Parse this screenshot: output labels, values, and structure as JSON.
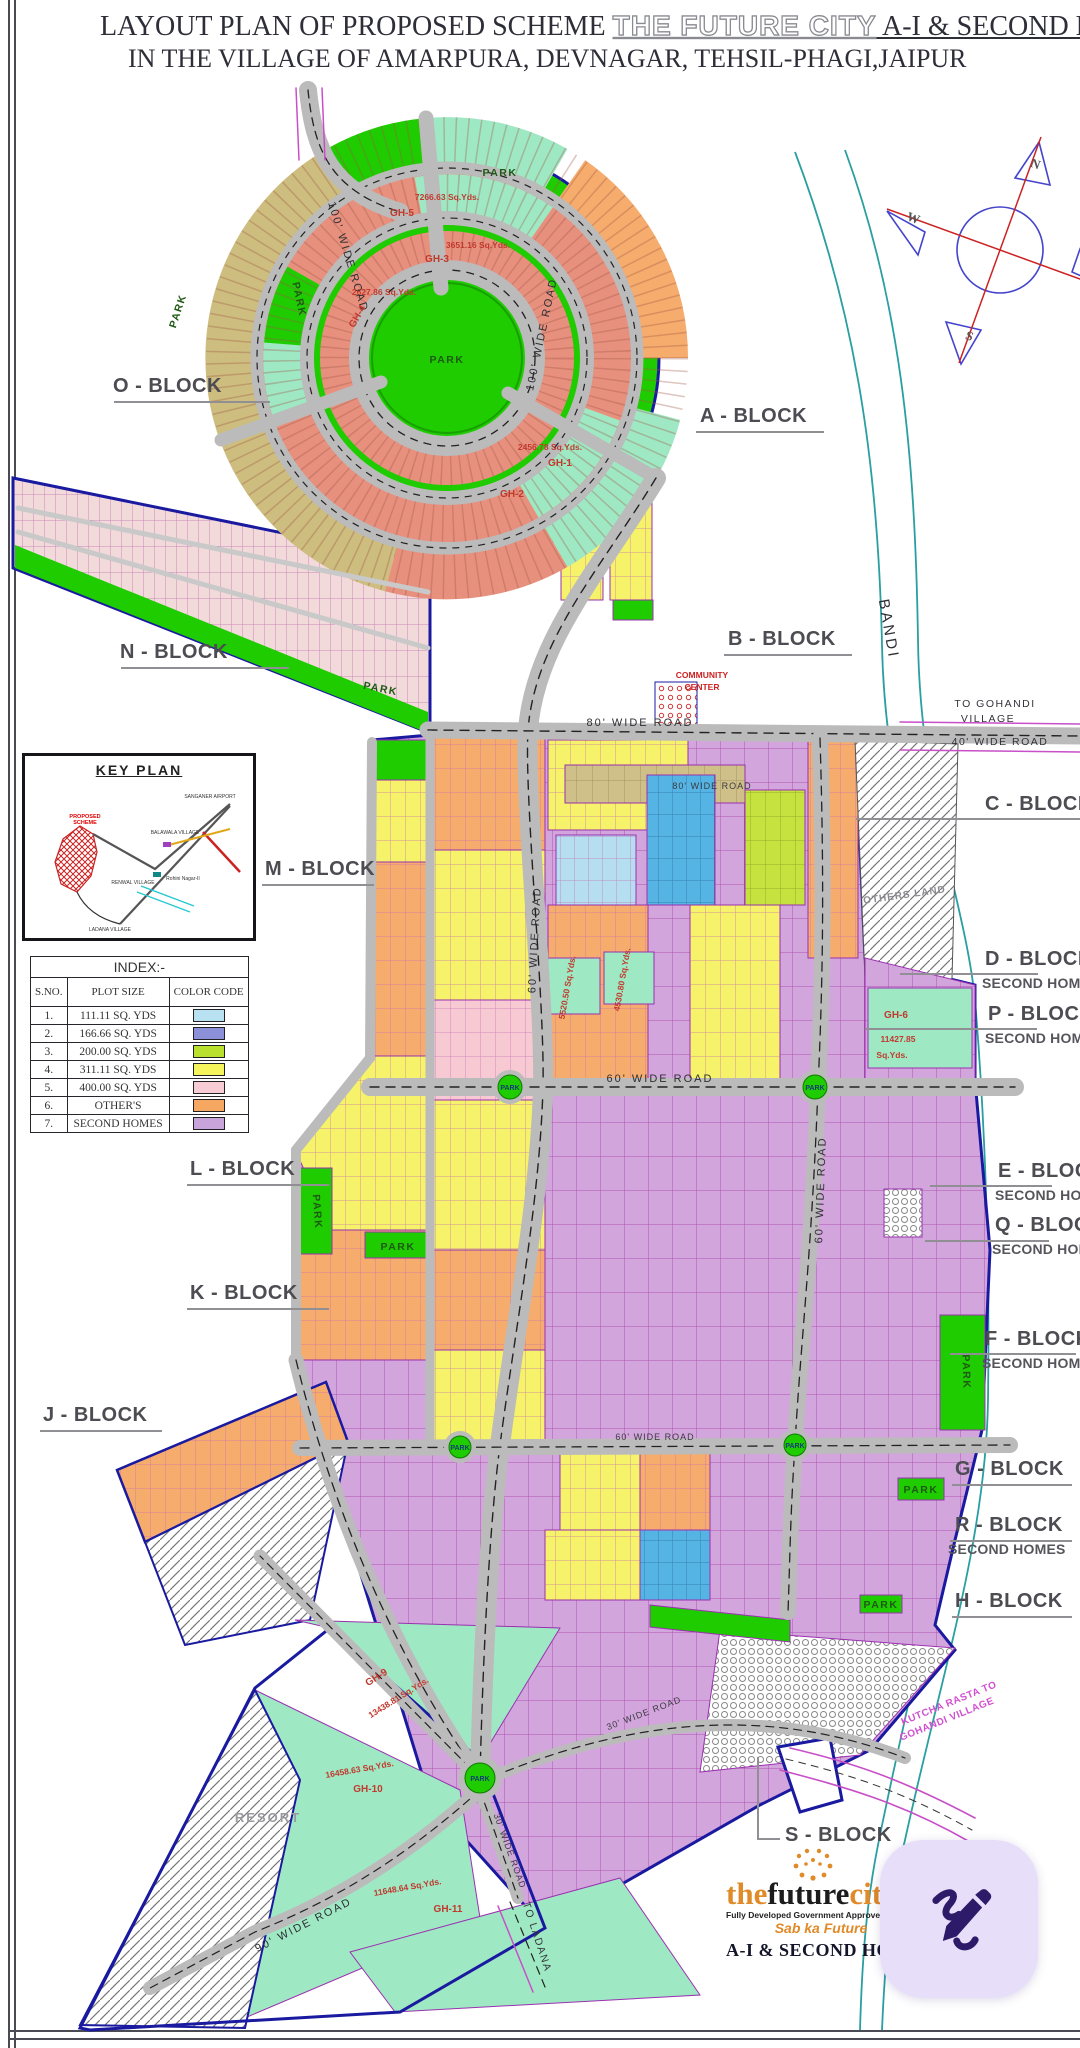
{
  "title": {
    "line1_prefix": "LAYOUT PLAN OF PROPOSED SCHEME ",
    "line1_brand": "THE FUTURE CITY",
    "line1_suffix": " A-I  & SECOND HOMES",
    "line2": "IN THE VILLAGE OF  AMARPURA, DEVNAGAR, TEHSIL-PHAGI,JAIPUR"
  },
  "blocks": {
    "o": "O - BLOCK",
    "a": "A - BLOCK",
    "n": "N - BLOCK",
    "b": "B - BLOCK",
    "c": "C - BLOCK",
    "m": "M - BLOCK",
    "d": "D - BLOCK",
    "p": "P - BLOCK",
    "l": "L - BLOCK",
    "e": "E - BLOCK",
    "q": "Q - BLOCK",
    "k": "K - BLOCK",
    "f": "F - BLOCK",
    "j": "J - BLOCK",
    "g": "G - BLOCK",
    "r": "R - BLOCK",
    "h": "H - BLOCK",
    "s": "S - BLOCK",
    "second_homes": "SECOND HOMES",
    "second_home": "SECOND HOME"
  },
  "index": {
    "title": "INDEX:-",
    "headers": [
      "S.NO.",
      "PLOT SIZE",
      "COLOR CODE"
    ],
    "rows": [
      {
        "sno": "1.",
        "size": "111.11 SQ. YDS",
        "color": "#b8e2f2"
      },
      {
        "sno": "2.",
        "size": "166.66 SQ. YDS",
        "color": "#8b90d8"
      },
      {
        "sno": "3.",
        "size": "200.00 SQ. YDS",
        "color": "#b8e02c"
      },
      {
        "sno": "4.",
        "size": "311.11 SQ. YDS",
        "color": "#f6f45c"
      },
      {
        "sno": "5.",
        "size": "400.00 SQ. YDS",
        "color": "#f8ccd4"
      },
      {
        "sno": "6.",
        "size": "OTHER'S",
        "color": "#f6a862"
      },
      {
        "sno": "7.",
        "size": "SECOND HOMES",
        "color": "#c9a4da"
      }
    ]
  },
  "key_plan": {
    "title": "KEY PLAN",
    "proposed_1": "PROPOSED",
    "proposed_2": "SCHEME",
    "airport": "SANGANER AIRPORT",
    "balawala": "BALAWALA VILLAGE",
    "renwal": "RENWAL VILLAGE",
    "rohini": "Rohini Nagar-II",
    "ladana": "LADANA VILLAGE"
  },
  "roads": {
    "r100": "100' WIDE ROAD",
    "r90": "90' WIDE ROAD",
    "r80": "80' WIDE ROAD",
    "r60": "60' WIDE ROAD",
    "r40": "40' WIDE ROAD",
    "r30": "30' WIDE ROAD"
  },
  "labels": {
    "park": "PARK",
    "bandi": "BANDI",
    "to_gohandi_1": "TO GOHANDI",
    "to_gohandi_2": "VILLAGE",
    "kutcha_1": "KUTCHA RASTA TO",
    "kutcha_2": "GOHANDI VILLAGE",
    "to_ladana": "TO LADANA",
    "resort": "RESORT",
    "others_land": "OTHERS LAND",
    "community_1": "COMMUNITY",
    "community_2": "CENTER"
  },
  "gh": {
    "gh1": "GH-1",
    "a1": "2456.78 Sq.Yds.",
    "gh2": "GH-2",
    "gh3": "GH-3",
    "a3": "3651.16 Sq.Yds.",
    "gh4": "GH-4",
    "a4": "2627.86 Sq.Yds.",
    "gh5": "GH-5",
    "a5": "7266.63 Sq.Yds.",
    "gh6": "GH-6",
    "a6_1": "11427.85",
    "a6_2": "Sq.Yds.",
    "gh9": "GH-9",
    "a9": "13438.81 Sq.Yds.",
    "gh10": "GH-10",
    "a10": "16458.63 Sq.Yds.",
    "gh11": "GH-11",
    "a11": "11648.64 Sq.Yds.",
    "ax1": "5520.50 Sq.Yds.",
    "ax2": "4530.80 Sq.Yds."
  },
  "compass": {
    "n": "N",
    "e": "E",
    "s": "S",
    "w": "W"
  },
  "logo": {
    "the": "the",
    "future": "future",
    "city": "city",
    "tagline": "Fully Developed Government Approved Township",
    "sab": "Sab ka Future",
    "scheme": "A-I  & SECOND HOMES"
  },
  "accent": {
    "fab_bg": "#e7defa",
    "fab_icon": "#2d1b69",
    "boundary": "#1a1aa0",
    "river": "#2a9ea0"
  }
}
